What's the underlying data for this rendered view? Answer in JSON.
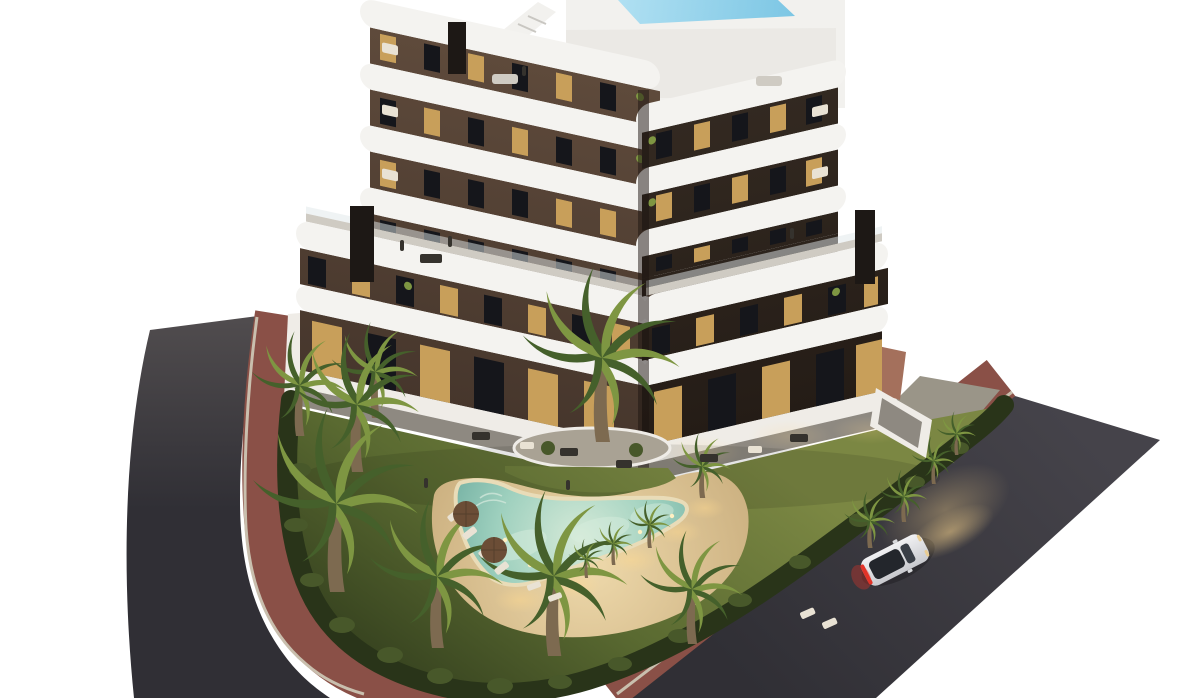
{
  "scene": {
    "description": "Dusk aerial 3D architectural rendering of a modern apartment building with dark brown facade and curved white wrap-around balconies, rooftop plunge pool and stair, landscaped corner garden with a boomerang-shaped illuminated swimming pool, sand deck with sun loungers and parasols, palm trees and hedges, red pedestrian sidewalks and two dark asphalt streets with one white car driving with headlights on"
  },
  "objects": {
    "building": {
      "wings": 2,
      "chimneys": 3,
      "rooftop_pool": true,
      "rooftop_stairs": true
    },
    "garden": {
      "pool_shape": "boomerang",
      "sun_loungers": 10,
      "parasols": 2,
      "palm_trees": 16
    },
    "streets": {
      "roads": 2,
      "cars": 1,
      "sidewalk_color": "red"
    }
  },
  "colors": {
    "background": "#ffffff",
    "road_top": "#504c4e",
    "road_dark": "#302f35",
    "road_right_top": "#45434a",
    "sidewalk_red": "#8a5047",
    "curb": "#c9bfae",
    "concrete": "#b2ada3",
    "concrete_olive": "#9a9588",
    "terracotta": "#a4705c",
    "wall_white": "#efece7",
    "lawn_light": "#7b8743",
    "lawn_mid": "#5a6a31",
    "lawn_dark": "#36421f",
    "hedge": "#293419",
    "bush": "#48582a",
    "palm_light": "#7e9642",
    "palm_dark": "#45602b",
    "palm_trunk": "#7d6a50",
    "island_gravel": "#a9a294",
    "sand_light": "#eed9ab",
    "sand_mid": "#cdb282",
    "glow_warm": "#ffd98f",
    "band_white": "#f4f3f0",
    "band_shade": "#cfcbc3",
    "glass_railing": "#dfe7ea",
    "facade_lit": "#5e4a3b",
    "facade_lit2": "#46362c",
    "facade_dark": "#342a22",
    "facade_dark2": "#241c16",
    "corner_shadow": "#1b1410",
    "window_dark": "#15161b",
    "window_warm": "#dcae62",
    "chimney": "#1d1815",
    "deck_white": "#f2f1ee",
    "rooftop_pool": "#7cc6e4",
    "rooftop_pool_light": "#b0e0f2",
    "pool_shallow": "#d6ead8",
    "pool_mid": "#9ed0be",
    "pool_deep": "#76b2a4",
    "pool_rim": "#e9dcb8",
    "pool_light_dot": "#fff0c2",
    "patio_gray": "#8e8981",
    "furniture_dark": "#35322d",
    "sofa_cream": "#e9e2d4",
    "umbrella": "#6b4d36",
    "car_body": "#f1f1f3",
    "car_body_shade": "#c8c9ce",
    "car_glass": "#23262c",
    "taillight": "#e23429",
    "headlight": "#e9cc92"
  }
}
